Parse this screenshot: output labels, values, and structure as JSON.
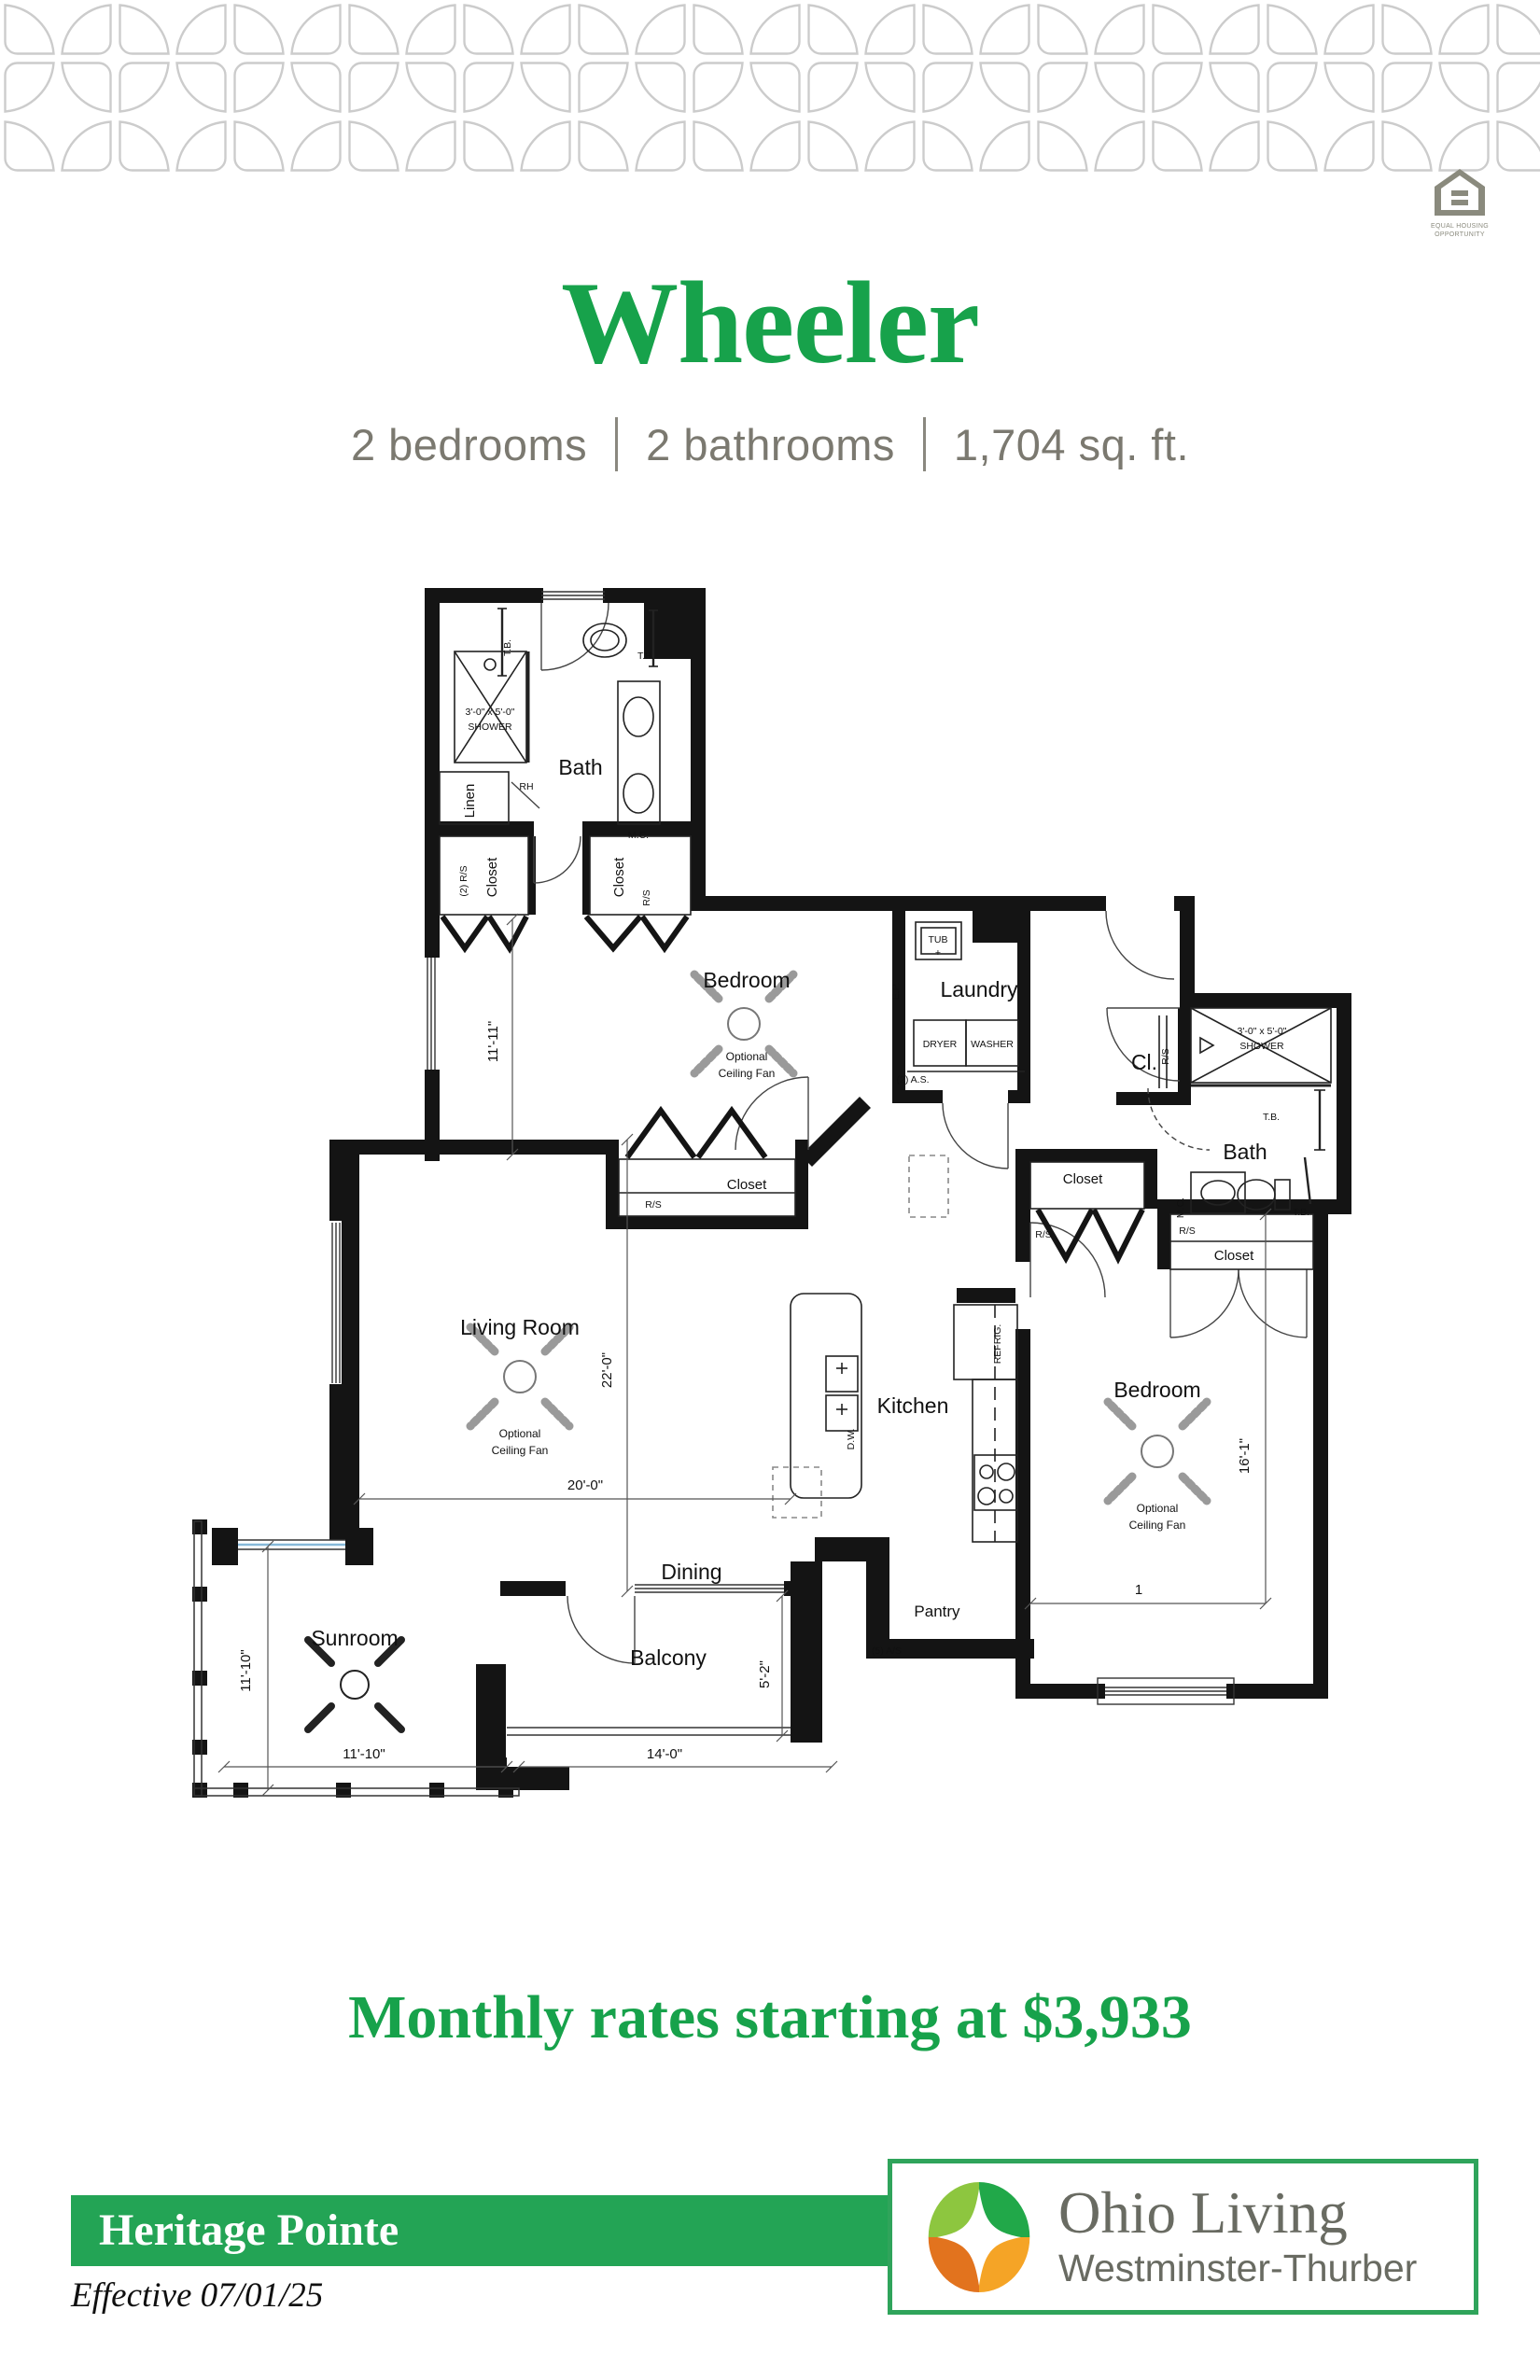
{
  "header": {
    "title": "Wheeler",
    "specs": {
      "bedrooms": "2 bedrooms",
      "bathrooms": "2 bathrooms",
      "sqft": "1,704 sq. ft."
    }
  },
  "eho": {
    "line1": "EQUAL HOUSING",
    "line2": "OPPORTUNITY"
  },
  "plan": {
    "rooms": {
      "bath": "Bath",
      "bedroom": "Bedroom",
      "laundry": "Laundry",
      "cl": "Cl.",
      "living": "Living Room",
      "kitchen": "Kitchen",
      "dining": "Dining",
      "sunroom": "Sunroom",
      "balcony": "Balcony",
      "pantry": "Pantry",
      "closet": "Closet",
      "linen": "Linen"
    },
    "labels": {
      "shower_size": "3'-0\" x 5'-0\"",
      "shower": "SHOWER",
      "tub": "TUB",
      "plus": "+",
      "dryer": "DRYER",
      "washer": "WASHER",
      "as2": "(2) A.S.",
      "ep": "E.P.",
      "rs": "R/S",
      "rs2": "(2) R/S",
      "as5": "(5) A/S",
      "refrig": "REFRIG.",
      "dw": "D.W.",
      "mc": "M.C.",
      "tb": "T.B.",
      "rh": "RH",
      "optional": "Optional",
      "ceiling_fan": "Ceiling Fan",
      "one": "1"
    },
    "dims": {
      "bed1_w": "11'-11\"",
      "lr_l": "22'-0\"",
      "lr_w": "20'-0\"",
      "bed2_l": "16'-1\"",
      "sun_v": "11'-10\"",
      "sun_h": "11'-10\"",
      "bal_w": "14'-0\"",
      "bal_d": "5'-2\""
    }
  },
  "pricing": {
    "headline": "Monthly rates starting at $3,933"
  },
  "footer": {
    "community": "Heritage Pointe",
    "effective": "Effective 07/01/25",
    "brand": {
      "name": "Ohio Living",
      "campus": "Westminster-Thurber"
    }
  },
  "colors": {
    "headline_green": "#17A24B",
    "bar_green": "#23A455",
    "logo_border_green": "#2FA45B",
    "subtitle_gray": "#7B7970",
    "logo_text_gray": "#696B62",
    "logo_light_green": "#8DC63F",
    "logo_dark_green": "#21A849",
    "logo_orange": "#E2731E",
    "logo_amber": "#F5A426"
  }
}
